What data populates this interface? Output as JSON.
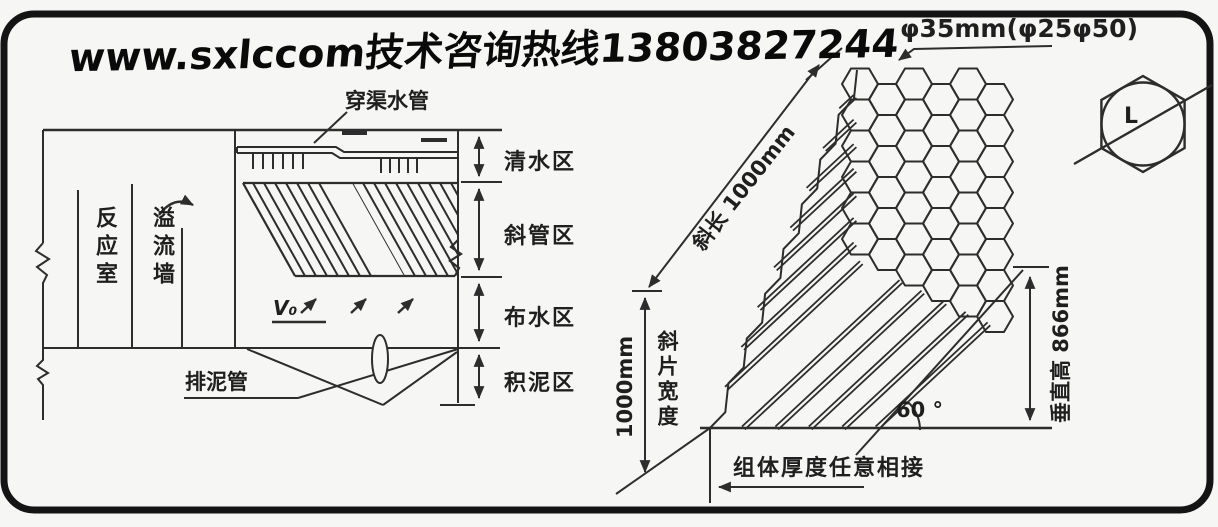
{
  "banner": {
    "text": "www.sxlccom技术咨询热线13803827244"
  },
  "colors": {
    "ink": "#2d2d2d",
    "paper": "#f6f6f4"
  },
  "left_diagram": {
    "labels": {
      "pipe": "穿渠水管",
      "reaction_chamber": "反应室",
      "overflow_wall": "溢流墙",
      "v0": "V₀",
      "sludge_pipe": "排泥管"
    },
    "zones": [
      {
        "label": "清水区"
      },
      {
        "label": "斜管区"
      },
      {
        "label": "布水区"
      },
      {
        "label": "积泥区"
      }
    ]
  },
  "right_diagram": {
    "labels": {
      "diameter": "φ35mm(φ25φ50)",
      "slant_length": "斜长 1000mm",
      "width_mm": "1000mm",
      "sheet_width": "斜片宽度",
      "vertical_height": "垂直高 866mm",
      "angle": "60 °",
      "module_note": "组体厚度任意相接",
      "hex_detail": "L"
    }
  }
}
